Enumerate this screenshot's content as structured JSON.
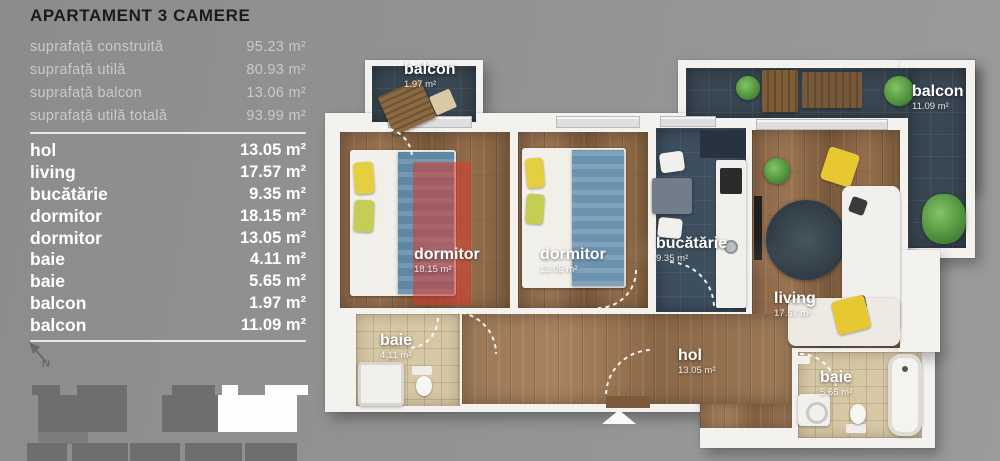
{
  "title": "APARTAMENT 3 CAMERE",
  "summary": {
    "rows": [
      {
        "label": "suprafață construită",
        "value": "95.23 m²"
      },
      {
        "label": "suprafață utilă",
        "value": "80.93 m²"
      },
      {
        "label": "suprafață balcon",
        "value": "13.06 m²"
      },
      {
        "label": "suprafață utilă totală",
        "value": "93.99 m²"
      }
    ]
  },
  "rooms": [
    {
      "name": "hol",
      "area": "13.05 m²"
    },
    {
      "name": "living",
      "area": "17.57 m²"
    },
    {
      "name": "bucătărie",
      "area": "9.35 m²"
    },
    {
      "name": "dormitor",
      "area": "18.15 m²"
    },
    {
      "name": "dormitor",
      "area": "13.05 m²"
    },
    {
      "name": "baie",
      "area": "4.11 m²"
    },
    {
      "name": "baie",
      "area": "5.65 m²"
    },
    {
      "name": "balcon",
      "area": "1.97 m²"
    },
    {
      "name": "balcon",
      "area": "11.09 m²"
    }
  ],
  "plan": {
    "balcon_small": {
      "name": "balcon",
      "area": "1.97 m²"
    },
    "balcon_large": {
      "name": "balcon",
      "area": "11.09 m²"
    },
    "dormitor_1": {
      "name": "dormitor",
      "area": "18.15 m²"
    },
    "dormitor_2": {
      "name": "dormitor",
      "area": "13.05 m²"
    },
    "bucatarie": {
      "name": "bucătărie",
      "area": "9.35 m²"
    },
    "living": {
      "name": "living",
      "area": "17.57 m²"
    },
    "baie_1": {
      "name": "baie",
      "area": "4.11 m²"
    },
    "baie_2": {
      "name": "baie",
      "area": "5.65 m²"
    },
    "hol": {
      "name": "hol",
      "area": "13.05 m²"
    }
  },
  "compass": {
    "label": "N"
  },
  "colors": {
    "background": "#929292",
    "title_text": "#1b1b1b",
    "summary_text": "#c9c9c9",
    "list_text": "#ffffff",
    "wall": "#f3f2ef",
    "wood_floor": "#8a6547",
    "dark_tile": "#3d4f5f",
    "bath_tile": "#d6c7a5",
    "highlight_red": "#db3a2e",
    "accent_yellow": "#e3cf3f",
    "plant_green": "#4e8f3c",
    "site_block": "#6e6e6e",
    "site_highlight": "#ffffff"
  }
}
